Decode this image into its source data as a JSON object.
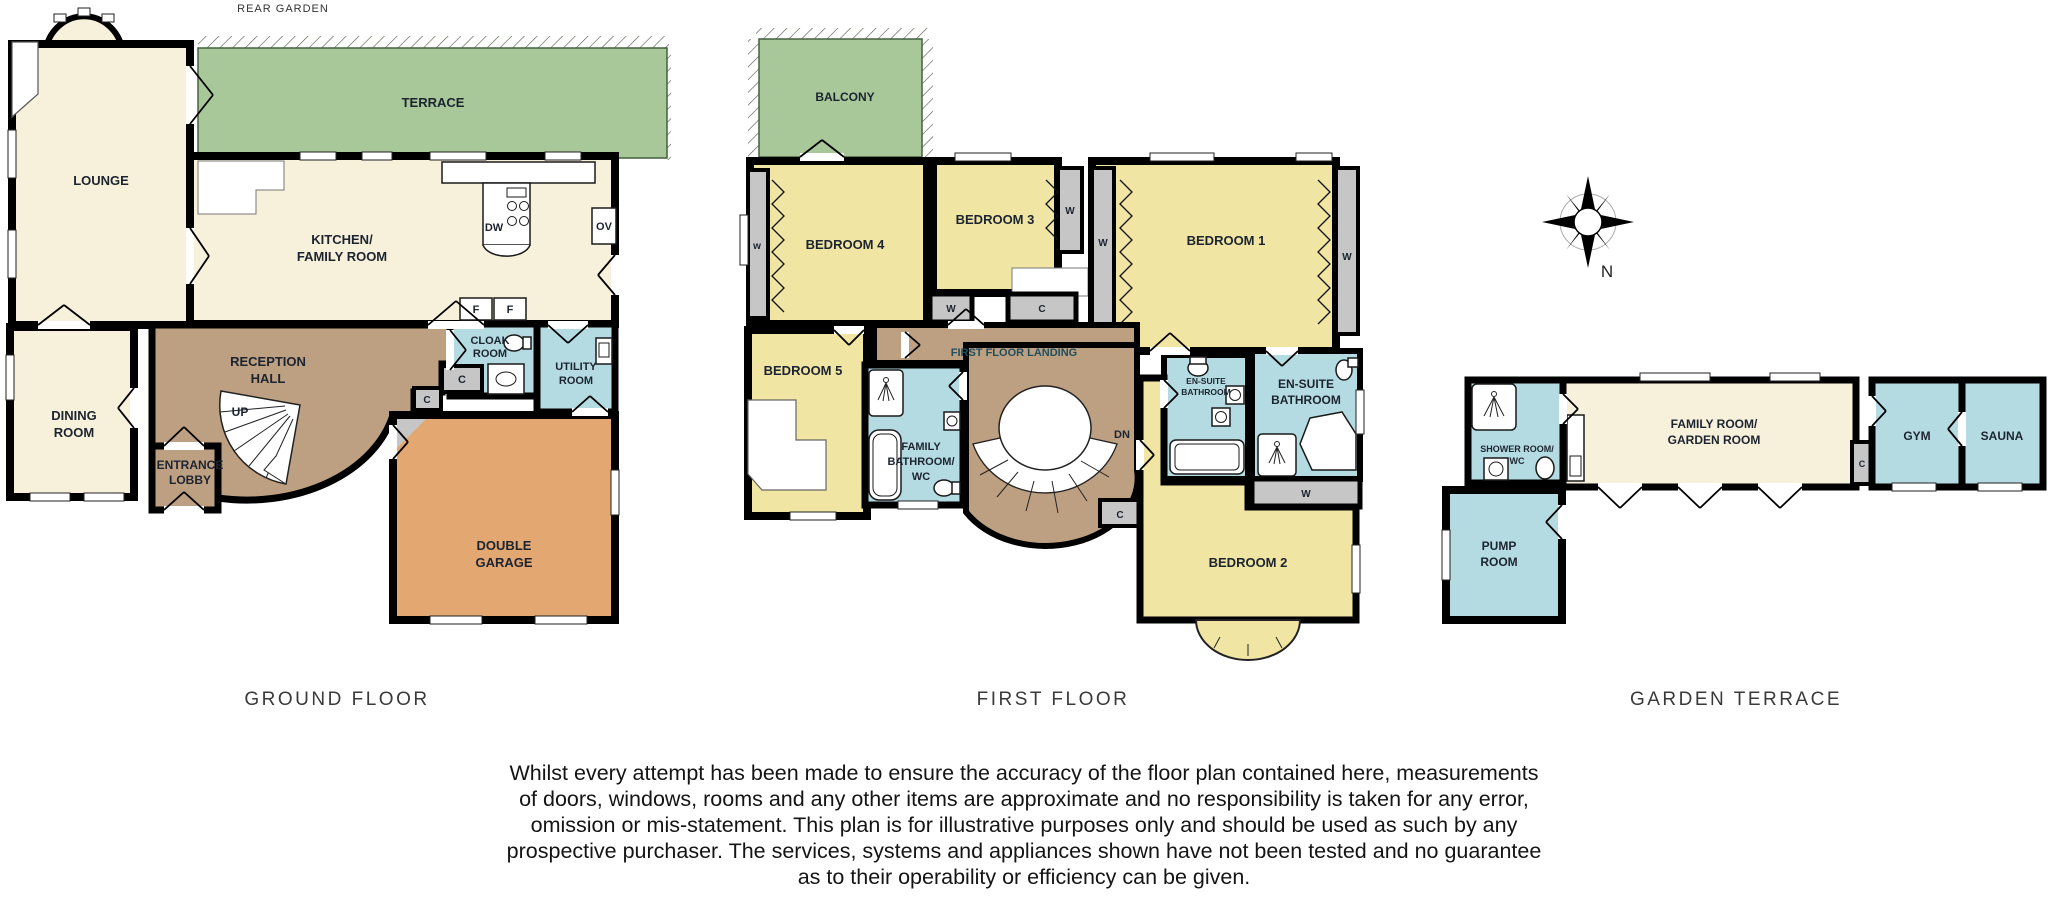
{
  "colors": {
    "cream": "#F7F0DB",
    "green": "#A8C89A",
    "yellow": "#F0E5A3",
    "blue": "#B5DBE2",
    "brown": "#BD9F81",
    "orange": "#E3A771",
    "gray": "#C6C6C6",
    "wall": "#000000",
    "label": "#1C2430",
    "title": "#3A3A3A"
  },
  "ground": {
    "title": "GROUND FLOOR",
    "rear_garden": "REAR GARDEN",
    "lounge": "LOUNGE",
    "terrace": "TERRACE",
    "kitchen_l1": "KITCHEN/",
    "kitchen_l2": "FAMILY ROOM",
    "dining_l1": "DINING",
    "dining_l2": "ROOM",
    "hall_l1": "RECEPTION",
    "hall_l2": "HALL",
    "lobby_l1": "ENTRANCE",
    "lobby_l2": "LOBBY",
    "cloak_l1": "CLOAK",
    "cloak_l2": "ROOM",
    "utility_l1": "UTILITY",
    "utility_l2": "ROOM",
    "garage_l1": "DOUBLE",
    "garage_l2": "GARAGE",
    "up": "UP",
    "dw": "DW",
    "ov": "OV",
    "f1": "F",
    "f2": "F",
    "c1": "C",
    "c2": "C"
  },
  "first": {
    "title": "FIRST FLOOR",
    "balcony": "BALCONY",
    "bed1": "BEDROOM 1",
    "bed2": "BEDROOM 2",
    "bed3": "BEDROOM 3",
    "bed4": "BEDROOM 4",
    "bed5": "BEDROOM 5",
    "landing": "FIRST FLOOR LANDING",
    "dn": "DN",
    "fam_l1": "FAMILY",
    "fam_l2": "BATHROOM/",
    "fam_l3": "WC",
    "es1_l1": "EN-SUITE",
    "es1_l2": "BATHROOM",
    "es2_l1": "EN-SUITE",
    "es2_l2": "BATHROOM",
    "w_small": "w",
    "w_bed3": "W",
    "w_bed1_left": "W",
    "w_bed1_right": "W",
    "w_closet": "W",
    "w_ensuite": "W",
    "c_closet": "C",
    "c_landing": "C"
  },
  "garden": {
    "title": "GARDEN TERRACE",
    "shower_l1": "SHOWER ROOM/",
    "shower_l2": "WC",
    "family_l1": "FAMILY ROOM/",
    "family_l2": "GARDEN ROOM",
    "gym": "GYM",
    "sauna": "SAUNA",
    "pump_l1": "PUMP",
    "pump_l2": "ROOM",
    "c": "C"
  },
  "compass": {
    "north": "N"
  },
  "disclaimer": {
    "l1": "Whilst every attempt has been made to ensure the accuracy of the floor plan contained here, measurements",
    "l2": "of doors, windows, rooms and any other items are approximate and no responsibility is taken for any error,",
    "l3": "omission or mis-statement. This plan is for illustrative purposes only and should be used as such by any",
    "l4": "prospective purchaser. The services, systems and appliances shown have not been tested and no guarantee",
    "l5": "as to their operability or efficiency can be given."
  }
}
